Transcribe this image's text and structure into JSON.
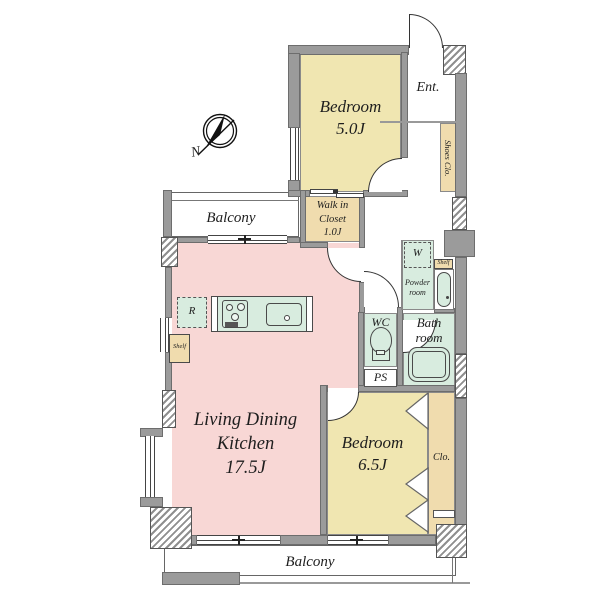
{
  "plan": {
    "rooms": {
      "bedroom_top": {
        "label": "Bedroom",
        "size": "5.0J"
      },
      "bedroom_bottom": {
        "label": "Bedroom",
        "size": "6.5J"
      },
      "ldk": {
        "line1": "Living Dining",
        "line2": "Kitchen",
        "size": "17.5J"
      },
      "walk_in_closet": {
        "line1": "Walk in",
        "line2": "Closet",
        "size": "1.0J"
      },
      "entrance": {
        "label": "Ent."
      },
      "shoes_closet": {
        "label": "Shoes Clo."
      },
      "balcony_top": {
        "label": "Balcony"
      },
      "balcony_bottom": {
        "label": "Balcony"
      },
      "wc": {
        "label": "WC"
      },
      "pipe_space": {
        "label": "PS"
      },
      "bathroom": {
        "line1": "Bath",
        "line2": "room"
      },
      "powder_room": {
        "line1": "Powder",
        "line2": "room"
      },
      "closet": {
        "label": "Clo."
      }
    },
    "fixtures": {
      "washer": "W",
      "refrigerator": "R",
      "shelf_powder": "Shelf",
      "shelf_kitchen": "Shelf"
    },
    "compass": {
      "north": "N"
    },
    "colors": {
      "room_pink": "#f8d7d5",
      "room_yellow": "#f0e6b1",
      "closet_tan": "#f0dcae",
      "wet_green": "#d8ecdf",
      "wall_gray": "#9b9b9b"
    }
  }
}
